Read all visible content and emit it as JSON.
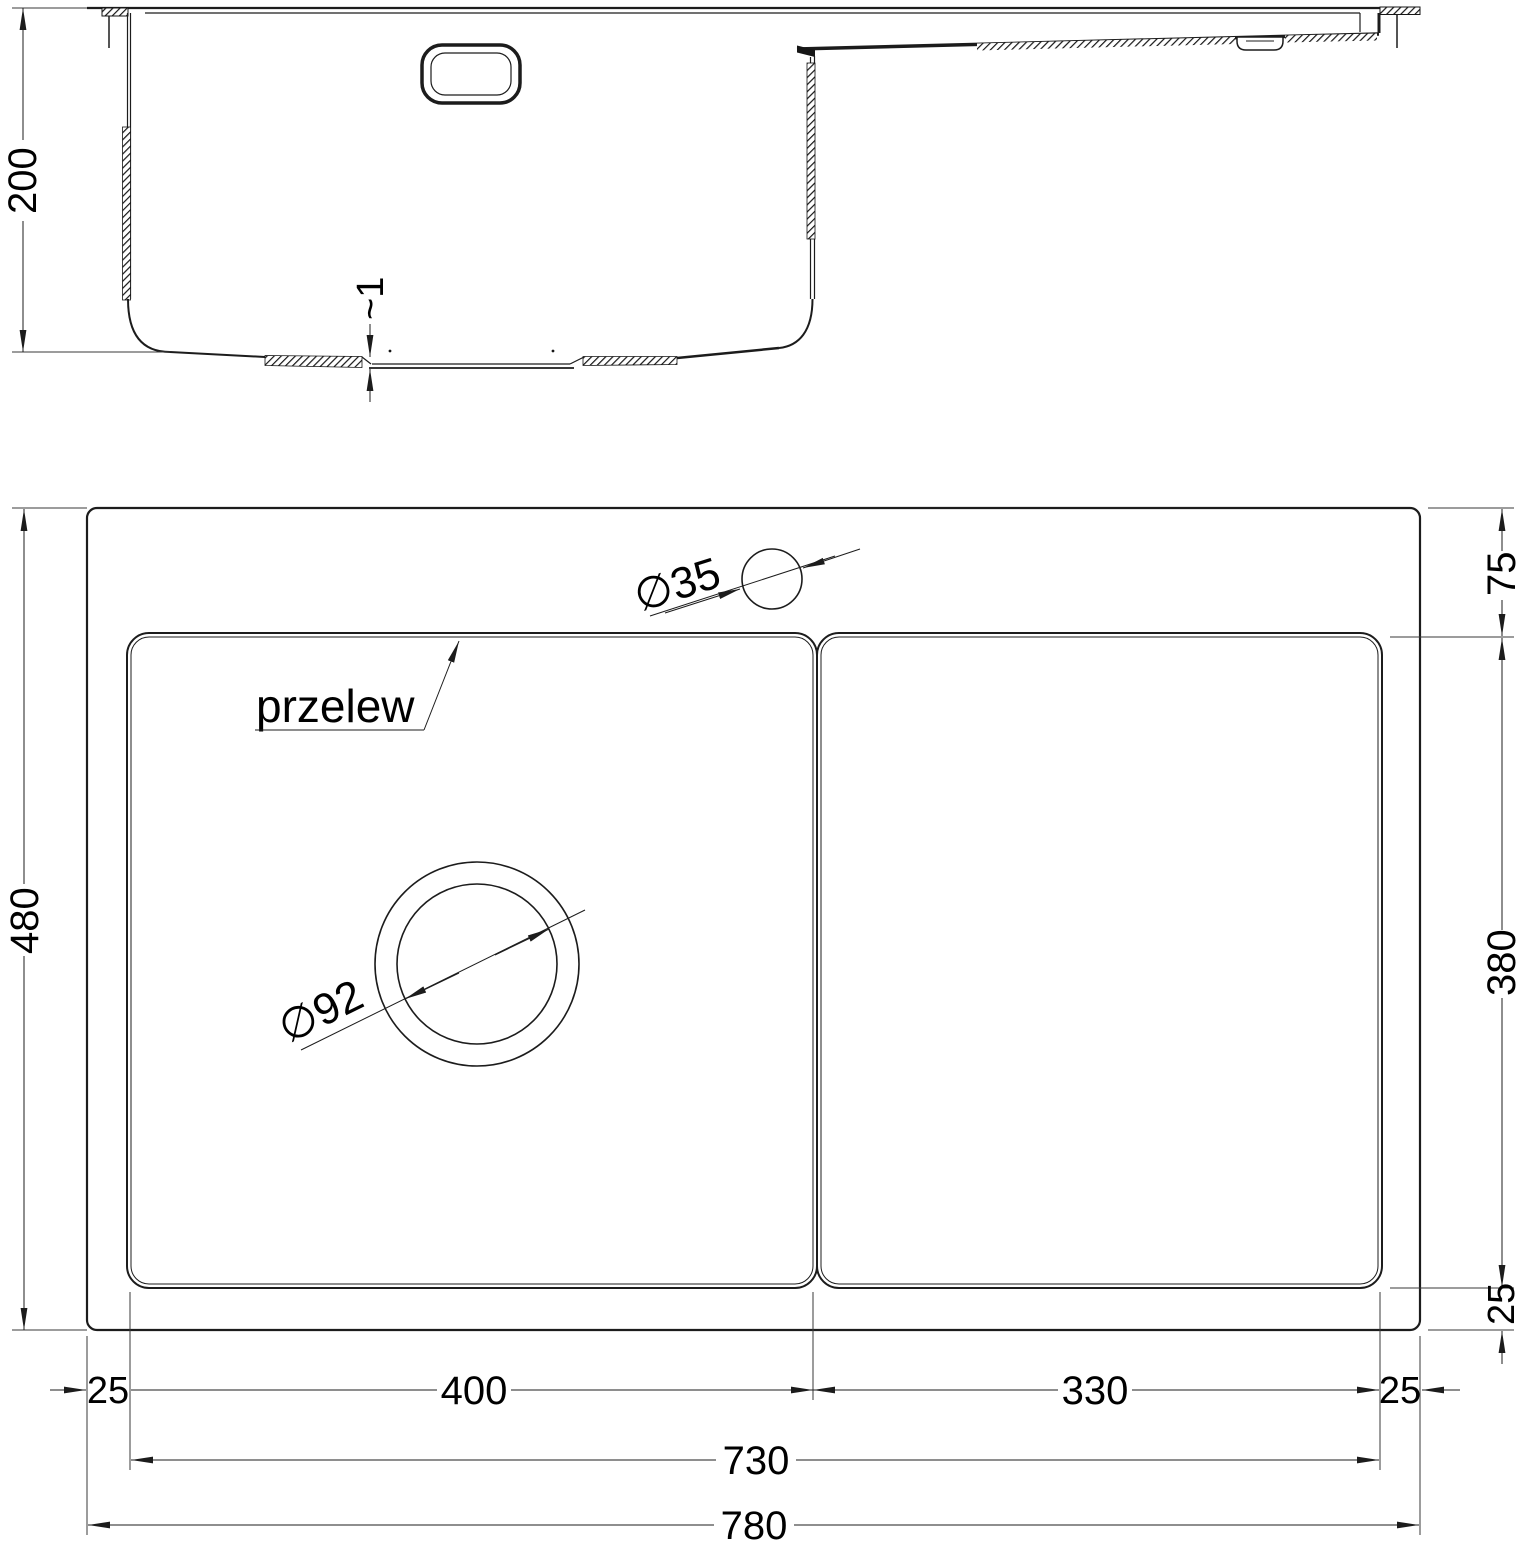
{
  "colors": {
    "line": "#1c1c1c",
    "thin_line": "#3a3a3a",
    "text": "#000000",
    "background": "#ffffff"
  },
  "section_view": {
    "depth_dim": "200",
    "bottom_step_dim": "~1"
  },
  "plan_view": {
    "height_dim": "480",
    "width_dim": "780",
    "inner_width_dim": "730",
    "left_rim_dim": "25",
    "bowl_width_dim": "400",
    "drainboard_width_dim": "330",
    "right_rim_dim": "25",
    "top_rim_dim": "75",
    "bowl_height_dim": "380",
    "bottom_rim_dim": "25",
    "faucet_hole_dim": "∅35",
    "drain_hole_dim": "∅92",
    "overflow_label": "przelew"
  }
}
